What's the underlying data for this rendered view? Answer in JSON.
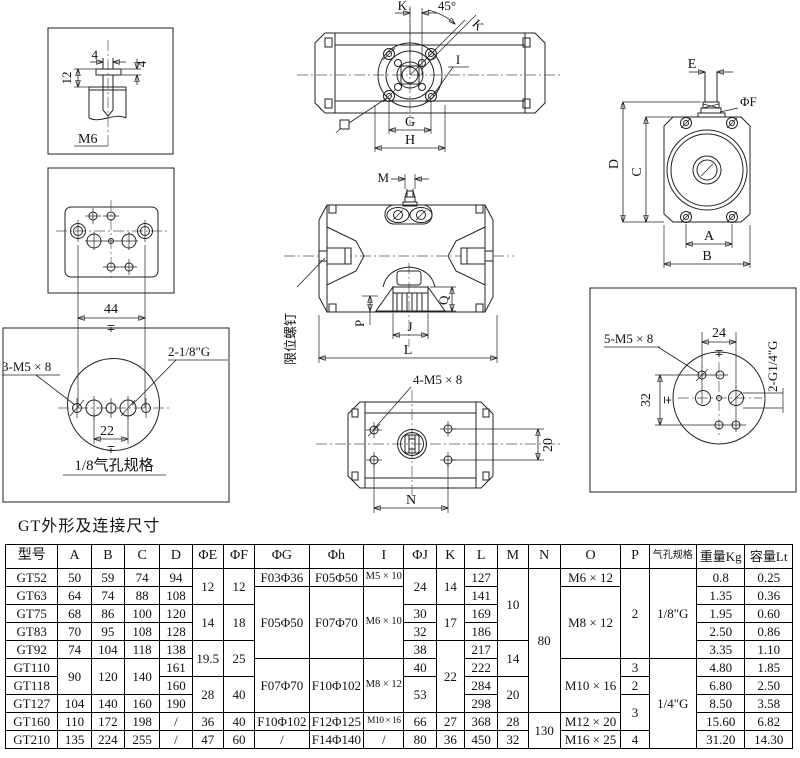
{
  "caption": "GT外形及连接尺寸",
  "drawings": {
    "shaft_detail": {
      "dim_slot_width": "4",
      "dim_tab_height": "4",
      "dim_depth": "12",
      "thread_label": "M6"
    },
    "plate_face": {
      "dim_width": "44",
      "tolerance": "∓"
    },
    "port_circle_18": {
      "screw_label": "3-M5 × 8",
      "port_label": "2-1/8\"G",
      "dim_pitch": "22",
      "tolerance": "∓",
      "caption": "1/8气孔规格"
    },
    "top_view": {
      "dim_k_top": "K",
      "angle_label": "45°",
      "dim_k_diag": "K",
      "label_i": "I",
      "dim_g": "G",
      "dim_h": "H"
    },
    "front_view": {
      "dim_m": "M",
      "limit_screw_label": "限位螺钉",
      "dim_p": "P",
      "dim_j": "J",
      "dim_q": "Q",
      "dim_l": "L"
    },
    "bottom_view": {
      "screw_label": "4-M5 × 8",
      "dim_height": "20",
      "dim_n": "N"
    },
    "end_view": {
      "dim_e": "E",
      "dim_f": "ΦF",
      "dim_d": "D",
      "dim_c": "C",
      "dim_a": "A",
      "dim_b": "B"
    },
    "port_circle_14": {
      "screw_label": "5-M5 × 8",
      "dim_24": "24",
      "dim_32": "32",
      "tolerance_24": "∓",
      "tolerance_32": "∓",
      "port_label": "2-G1/4\"G"
    }
  },
  "table": {
    "columns": [
      "型号",
      "A",
      "B",
      "C",
      "D",
      "ΦE",
      "ΦF",
      "ΦG",
      "Φh",
      "I",
      "ΦJ",
      "K",
      "L",
      "M",
      "N",
      "O",
      "P",
      "气孔规格",
      "重量Kg",
      "容量Lt"
    ],
    "col_widths": [
      52,
      33,
      33,
      35,
      32,
      31,
      31,
      54,
      54,
      40,
      32,
      28,
      33,
      30,
      32,
      60,
      28,
      47,
      48,
      47
    ],
    "rows": [
      [
        {
          "t": "GT52"
        },
        {
          "t": "50"
        },
        {
          "t": "59"
        },
        {
          "t": "74"
        },
        {
          "t": "94"
        },
        {
          "t": "12",
          "rs": 2
        },
        {
          "t": "12",
          "rs": 2
        },
        {
          "t": "F03Φ36"
        },
        {
          "t": "F05Φ50"
        },
        {
          "t": "M5 × 10",
          "cls": "sm"
        },
        {
          "t": "24",
          "rs": 2
        },
        {
          "t": "14",
          "rs": 2
        },
        {
          "t": "127"
        },
        {
          "t": "10",
          "rs": 4
        },
        {
          "t": "80",
          "rs": 8
        },
        {
          "t": "M6 × 12"
        },
        {
          "t": "2",
          "rs": 5
        },
        {
          "t": "1/8\"G",
          "rs": 5
        },
        {
          "t": "0.8"
        },
        {
          "t": "0.25"
        }
      ],
      [
        {
          "t": "GT63"
        },
        {
          "t": "64"
        },
        {
          "t": "74"
        },
        {
          "t": "88"
        },
        {
          "t": "108"
        },
        null,
        null,
        {
          "t": "F05Φ50",
          "rs": 4
        },
        {
          "t": "F07Φ70",
          "rs": 4
        },
        {
          "t": "M6 × 10",
          "rs": 4,
          "cls": "sm"
        },
        null,
        null,
        {
          "t": "141"
        },
        null,
        null,
        {
          "t": "M8 × 12",
          "rs": 4
        },
        null,
        null,
        {
          "t": "1.35"
        },
        {
          "t": "0.36"
        }
      ],
      [
        {
          "t": "GT75"
        },
        {
          "t": "68"
        },
        {
          "t": "86"
        },
        {
          "t": "100"
        },
        {
          "t": "120"
        },
        {
          "t": "14",
          "rs": 2
        },
        {
          "t": "18",
          "rs": 2
        },
        null,
        null,
        null,
        {
          "t": "30"
        },
        {
          "t": "17",
          "rs": 2
        },
        {
          "t": "169"
        },
        null,
        null,
        null,
        null,
        null,
        {
          "t": "1.95"
        },
        {
          "t": "0.60"
        }
      ],
      [
        {
          "t": "GT83"
        },
        {
          "t": "70"
        },
        {
          "t": "95"
        },
        {
          "t": "108"
        },
        {
          "t": "128"
        },
        null,
        null,
        null,
        null,
        null,
        {
          "t": "32"
        },
        null,
        {
          "t": "186"
        },
        null,
        null,
        null,
        null,
        null,
        {
          "t": "2.50"
        },
        {
          "t": "0.86"
        }
      ],
      [
        {
          "t": "GT92"
        },
        {
          "t": "74"
        },
        {
          "t": "104"
        },
        {
          "t": "118"
        },
        {
          "t": "138"
        },
        {
          "t": "19.5",
          "rs": 2
        },
        {
          "t": "25",
          "rs": 2
        },
        null,
        null,
        null,
        {
          "t": "38"
        },
        {
          "t": "22",
          "rs": 4
        },
        {
          "t": "217"
        },
        {
          "t": "14",
          "rs": 2
        },
        null,
        null,
        null,
        null,
        {
          "t": "3.35"
        },
        {
          "t": "1.10"
        }
      ],
      [
        {
          "t": "GT110"
        },
        {
          "t": "90",
          "rs": 2
        },
        {
          "t": "120",
          "rs": 2
        },
        {
          "t": "140",
          "rs": 2
        },
        {
          "t": "161"
        },
        null,
        null,
        {
          "t": "F07Φ70",
          "rs": 3
        },
        {
          "t": "F10Φ102",
          "rs": 3
        },
        {
          "t": "M8 × 12",
          "rs": 3,
          "cls": "sm"
        },
        {
          "t": "40"
        },
        null,
        {
          "t": "222"
        },
        null,
        null,
        {
          "t": "M10 × 16",
          "rs": 3
        },
        {
          "t": "3"
        },
        {
          "t": "1/4\"G",
          "rs": 5
        },
        {
          "t": "4.80"
        },
        {
          "t": "1.85"
        }
      ],
      [
        {
          "t": "GT118"
        },
        null,
        null,
        null,
        {
          "t": "160"
        },
        {
          "t": "28",
          "rs": 2
        },
        {
          "t": "40",
          "rs": 2
        },
        null,
        null,
        null,
        {
          "t": "53",
          "rs": 2
        },
        null,
        {
          "t": "284"
        },
        {
          "t": "20",
          "rs": 2
        },
        null,
        null,
        {
          "t": "2"
        },
        null,
        {
          "t": "6.80"
        },
        {
          "t": "2.50"
        }
      ],
      [
        {
          "t": "GT127"
        },
        {
          "t": "104"
        },
        {
          "t": "140"
        },
        {
          "t": "160"
        },
        {
          "t": "190"
        },
        null,
        null,
        null,
        null,
        null,
        null,
        null,
        {
          "t": "298"
        },
        null,
        null,
        null,
        {
          "t": "3",
          "rs": 2
        },
        null,
        {
          "t": "8.50"
        },
        {
          "t": "3.58"
        }
      ],
      [
        {
          "t": "GT160"
        },
        {
          "t": "110"
        },
        {
          "t": "172"
        },
        {
          "t": "198"
        },
        {
          "t": "/"
        },
        {
          "t": "36"
        },
        {
          "t": "40"
        },
        {
          "t": "F10Φ102"
        },
        {
          "t": "F12Φ125"
        },
        {
          "t": "M10 × 16",
          "cls": "xs"
        },
        {
          "t": "66"
        },
        {
          "t": "27"
        },
        {
          "t": "368"
        },
        {
          "t": "28"
        },
        {
          "t": "130",
          "rs": 2
        },
        {
          "t": "M12 × 20"
        },
        null,
        null,
        {
          "t": "15.60"
        },
        {
          "t": "6.82"
        }
      ],
      [
        {
          "t": "GT210"
        },
        {
          "t": "135"
        },
        {
          "t": "224"
        },
        {
          "t": "255"
        },
        {
          "t": "/"
        },
        {
          "t": "47"
        },
        {
          "t": "60"
        },
        {
          "t": "/"
        },
        {
          "t": "F14Φ140"
        },
        {
          "t": "/"
        },
        {
          "t": "80"
        },
        {
          "t": "36"
        },
        {
          "t": "450"
        },
        {
          "t": "32"
        },
        null,
        {
          "t": "M16 × 25"
        },
        {
          "t": "4"
        },
        null,
        {
          "t": "31.20"
        },
        {
          "t": "14.30"
        }
      ]
    ]
  }
}
